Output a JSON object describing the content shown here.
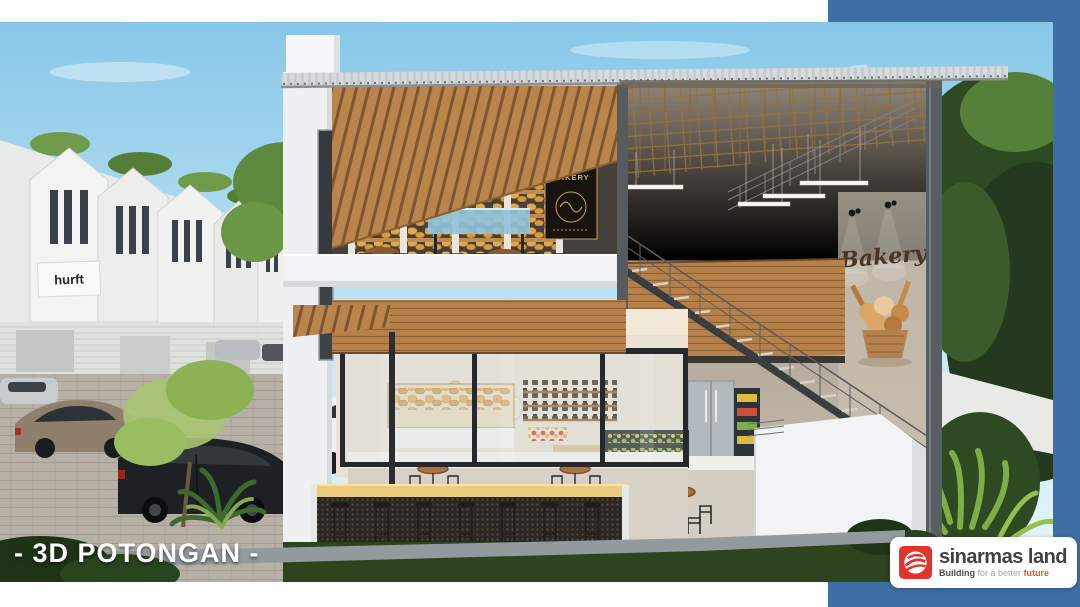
{
  "frame": {
    "accent_color": "#3e6fa4"
  },
  "caption": {
    "text": "- 3D POTONGAN -"
  },
  "scene": {
    "house_sign_text": "hurft",
    "bakery_poster_text": "BAKERY",
    "wall_mural_text": "Bakery"
  },
  "logo_card": {
    "brand": "sinarmas land",
    "tagline_word1": "Building",
    "tagline_word2": "for a better",
    "tagline_word3": "future",
    "brand_color": "#414042",
    "logo_red": "#e2342b"
  }
}
